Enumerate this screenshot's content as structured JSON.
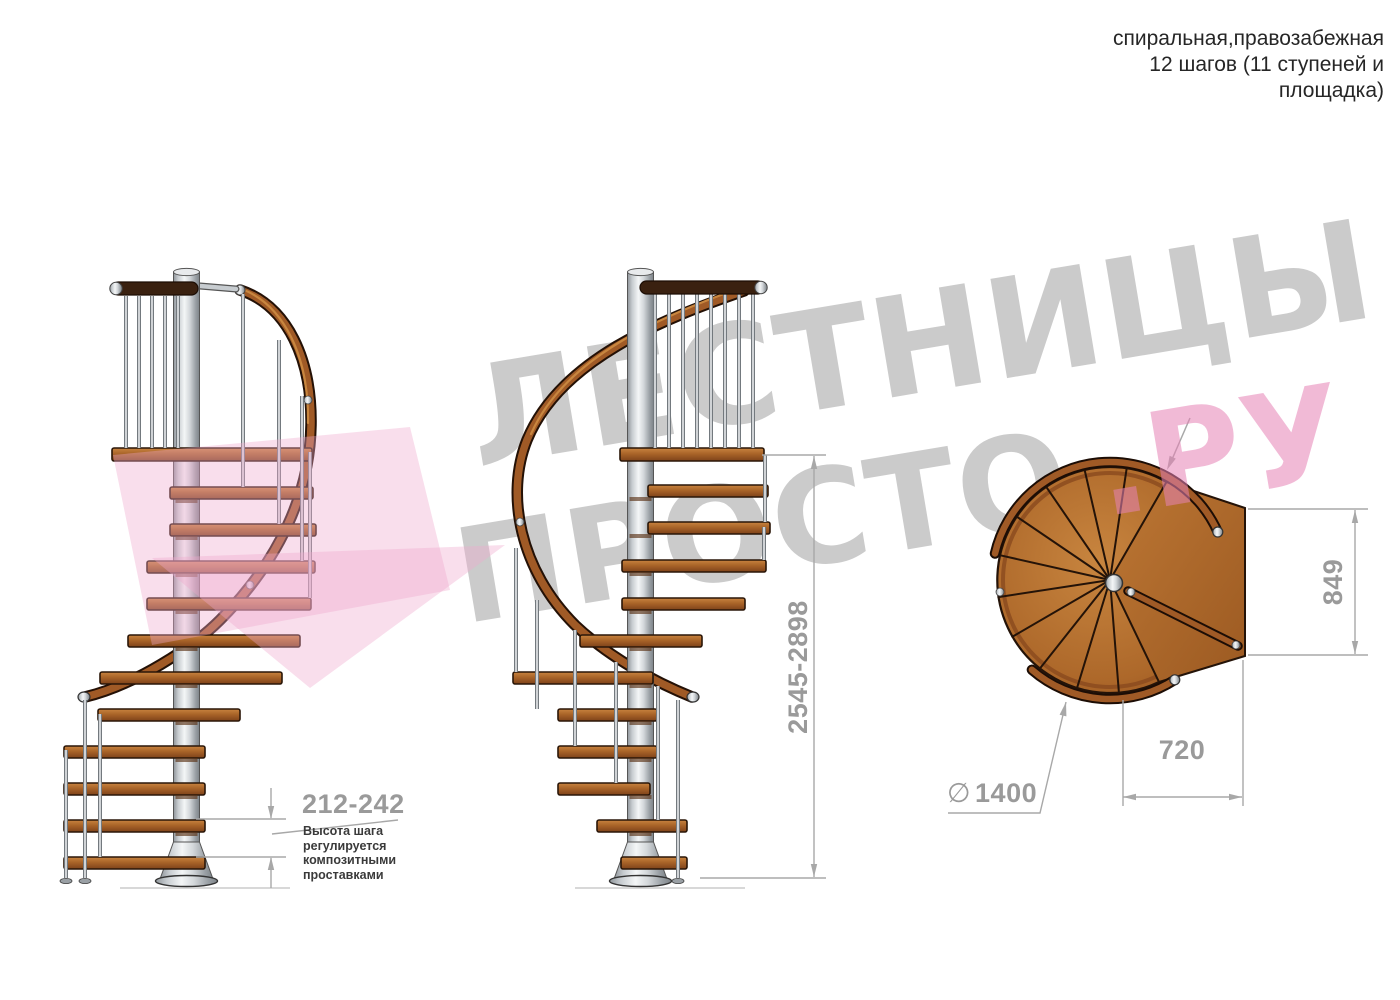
{
  "header": {
    "line1": "спиральная,правозабежная",
    "line2": "12 шагов (11 ступеней и",
    "line3": "площадка)"
  },
  "watermark": {
    "line1": "ЛЕСТНИЦЫ",
    "line2_gray": "ПРОСТО",
    "line2_pink": ".РУ",
    "gray_color": "#cbcbcb",
    "pink_color": "#f2b9d8"
  },
  "dimensions": {
    "step_height": "212-242",
    "total_height": "2545-2898",
    "landing_width": "849",
    "landing_depth": "720",
    "diameter_symbol": "∅",
    "diameter_value": "1400"
  },
  "note": {
    "line1": "Высота шага",
    "line2": "регулируется",
    "line3": "композитными",
    "line4": "проставками"
  },
  "colors": {
    "wood": "#a5612a",
    "dark_rail": "#3a2110",
    "metal": "#d6dadd",
    "dimension_text": "#9a9a9a",
    "dimension_line": "#a8a8a8",
    "note_text": "#3a3a3a"
  }
}
